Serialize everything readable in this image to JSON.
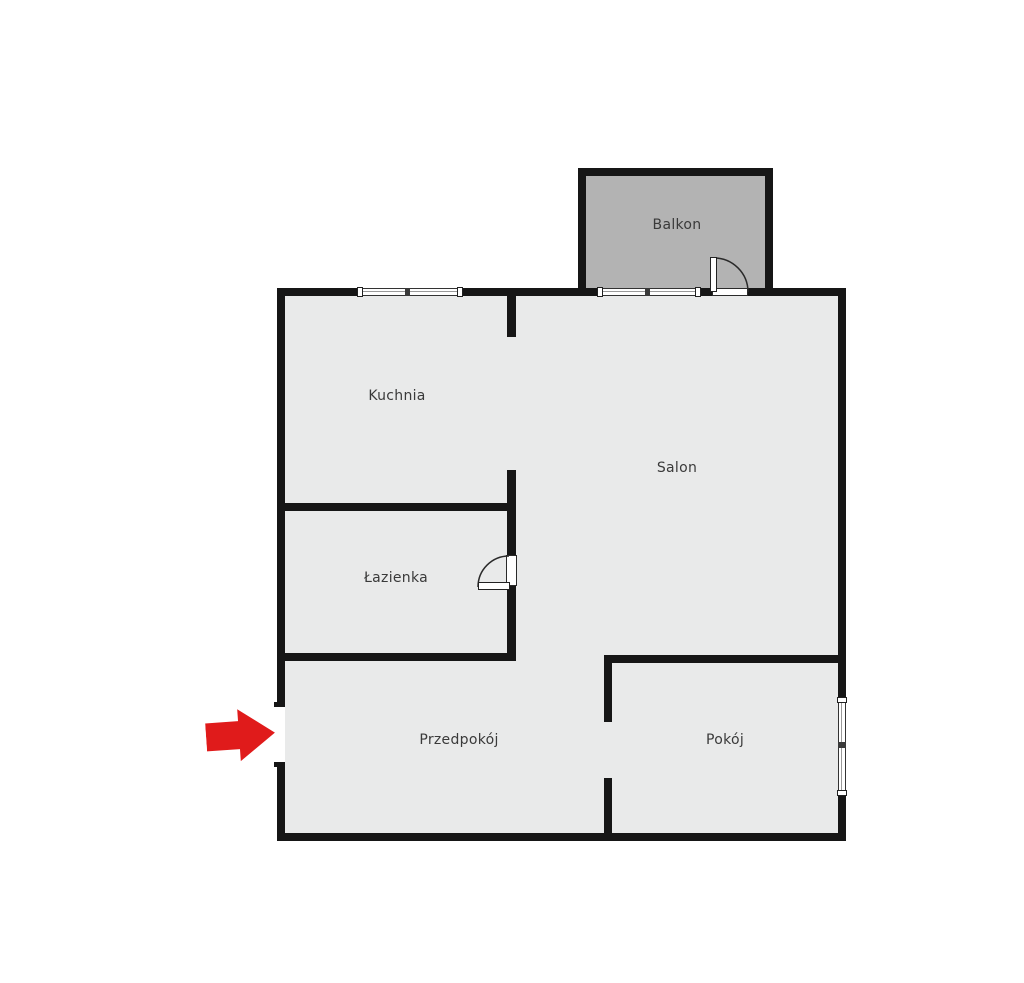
{
  "colors": {
    "wall": "#161616",
    "floor": "#e9eaea",
    "balcony_floor": "#b3b3b3",
    "background": "#ffffff",
    "arrow": "#e01b1b",
    "label_text": "#3a3a3a",
    "window_fill": "#ffffff"
  },
  "rooms": [
    {
      "id": "balkon",
      "label": "Balkon"
    },
    {
      "id": "kuchnia",
      "label": "Kuchnia"
    },
    {
      "id": "salon",
      "label": "Salon"
    },
    {
      "id": "lazienka",
      "label": "Łazienka"
    },
    {
      "id": "przedpokoj",
      "label": "Przedpokój"
    },
    {
      "id": "pokoj",
      "label": "Pokój"
    }
  ],
  "entrance": {
    "arrow_icon": "red-right-arrow"
  }
}
